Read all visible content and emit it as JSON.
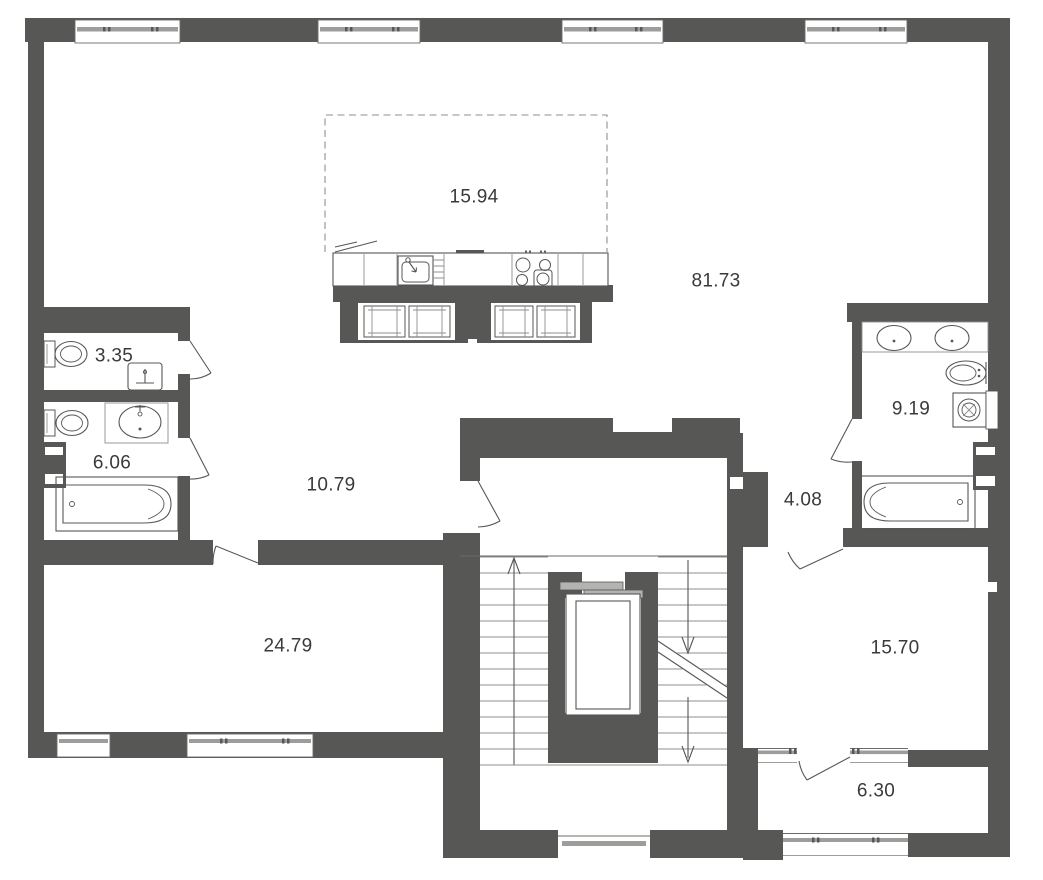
{
  "plan": {
    "title": "apartment-floor-plan",
    "rooms": [
      {
        "name": "kitchen-zone",
        "area": "15.94"
      },
      {
        "name": "living-room",
        "area": "81.73"
      },
      {
        "name": "wc",
        "area": "3.35"
      },
      {
        "name": "bathroom-small",
        "area": "6.06"
      },
      {
        "name": "bathroom-large",
        "area": "9.19"
      },
      {
        "name": "hallway",
        "area": "10.79"
      },
      {
        "name": "corridor",
        "area": "4.08"
      },
      {
        "name": "room-bottom-left",
        "area": "24.79"
      },
      {
        "name": "room-bottom-right",
        "area": "15.70"
      },
      {
        "name": "balcony",
        "area": "6.30"
      }
    ],
    "fixtures": [
      "toilet-icon",
      "sink-icon",
      "bathtub-icon",
      "double-sink-icon",
      "washing-machine-icon",
      "radiator-icon",
      "kitchen-sink-icon",
      "stove-icon",
      "vent-duct-icon",
      "elevator-icon",
      "stairs-up-arrow",
      "stairs-down-arrow",
      "window-icon",
      "door-swing-icon"
    ],
    "colors": {
      "wall": "#575756",
      "muted_line": "#9d9d9c",
      "text": "#3a3a39",
      "background": "#ffffff"
    }
  }
}
